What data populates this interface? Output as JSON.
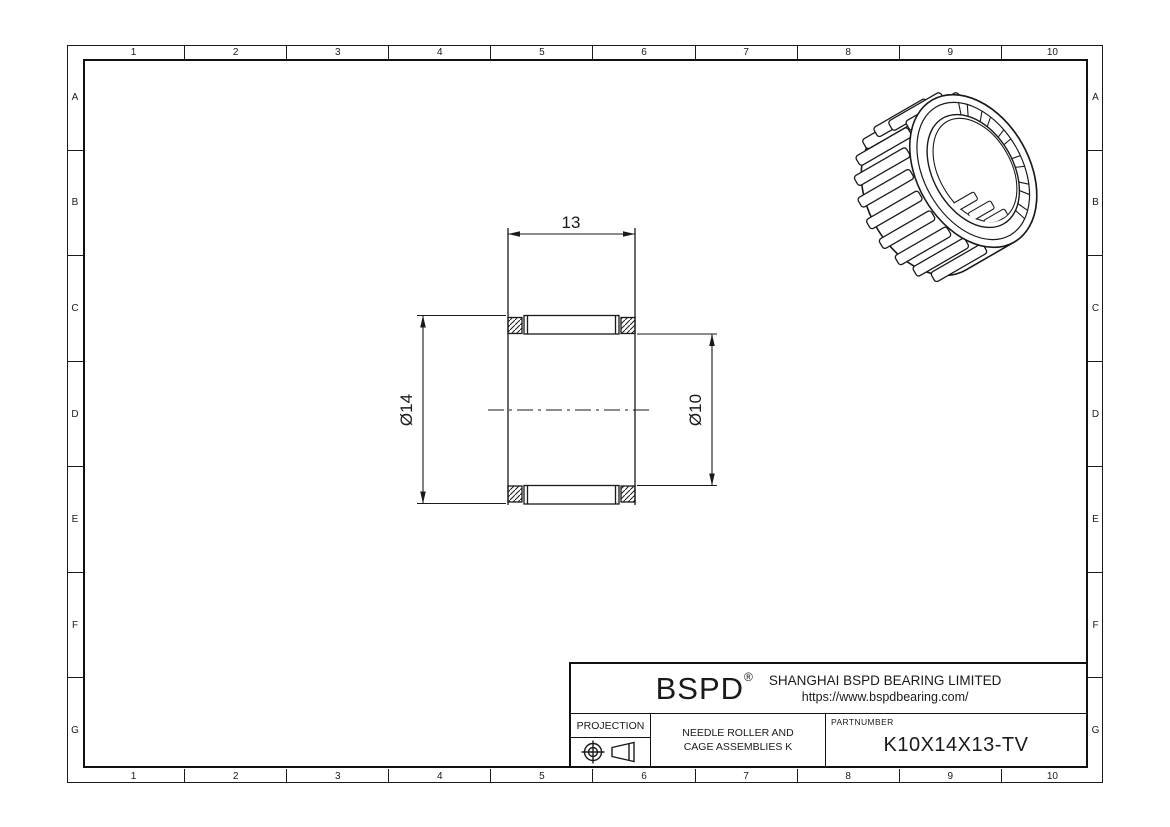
{
  "frame": {
    "columns": [
      "1",
      "2",
      "3",
      "4",
      "5",
      "6",
      "7",
      "8",
      "9",
      "10"
    ],
    "rows": [
      "A",
      "B",
      "C",
      "D",
      "E",
      "F",
      "G"
    ]
  },
  "drawing": {
    "width_dim": "13",
    "outer_diameter_dim": "Ø14",
    "inner_diameter_dim": "Ø10"
  },
  "title_block": {
    "logo": "BSPD",
    "logo_mark": "®",
    "company": "SHANGHAI BSPD BEARING LIMITED",
    "website": "https://www.bspdbearing.com/",
    "projection_label": "PROJECTION",
    "product_line1": "NEEDLE ROLLER AND",
    "product_line2": "CAGE ASSEMBLIES K",
    "partnumber_label": "PARTNUMBER",
    "part_number": "K10X14X13-TV"
  },
  "icons": {
    "projection_symbol": "first-angle-projection-icon",
    "bearing_view": "needle-roller-cage-3d-view"
  },
  "colors": {
    "background": "#ffffff",
    "line": "#1a1a1a"
  }
}
